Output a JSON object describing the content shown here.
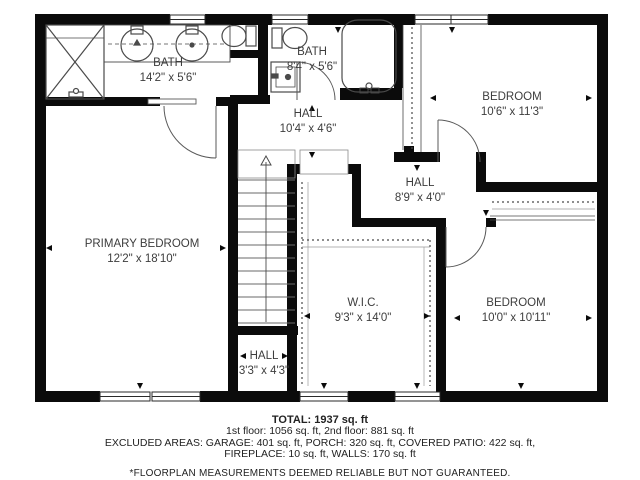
{
  "plan": {
    "title": "second-floor-plan",
    "rooms": [
      {
        "name": "bath-1",
        "label": "BATH",
        "dims": "14'2\" x 5'6\""
      },
      {
        "name": "bath-2",
        "label": "BATH",
        "dims": "8'4\" x 5'6\""
      },
      {
        "name": "hall-upper",
        "label": "HALL",
        "dims": "10'4\" x 4'6\""
      },
      {
        "name": "bedroom-top-right",
        "label": "BEDROOM",
        "dims": "10'6\" x 11'3\""
      },
      {
        "name": "hall-mid",
        "label": "HALL",
        "dims": "8'9\" x 4'0\""
      },
      {
        "name": "primary-bedroom",
        "label": "PRIMARY BEDROOM",
        "dims": "12'2\" x 18'10\""
      },
      {
        "name": "wic",
        "label": "W.I.C.",
        "dims": "9'3\" x 14'0\""
      },
      {
        "name": "bedroom-bottom-right",
        "label": "BEDROOM",
        "dims": "10'0\" x 10'11\""
      },
      {
        "name": "hall-lower",
        "label": "HALL",
        "dims": "3'3\" x 4'3\""
      }
    ]
  },
  "footer": {
    "total": "TOTAL: 1937 sq. ft",
    "floors": "1st floor: 1056 sq. ft, 2nd floor: 881 sq. ft",
    "excluded_1": "EXCLUDED AREAS: GARAGE: 401 sq. ft, PORCH: 320 sq. ft, COVERED PATIO: 422 sq. ft,",
    "excluded_2": "FIREPLACE: 10 sq. ft, WALLS: 170 sq. ft",
    "disclaimer": "*FLOORPLAN MEASUREMENTS DEEMED RELIABLE BUT NOT GUARANTEED."
  },
  "colors": {
    "wall": "#0b0b0b",
    "fixture": "#4a4a4a",
    "label": "#3d3d3d"
  }
}
